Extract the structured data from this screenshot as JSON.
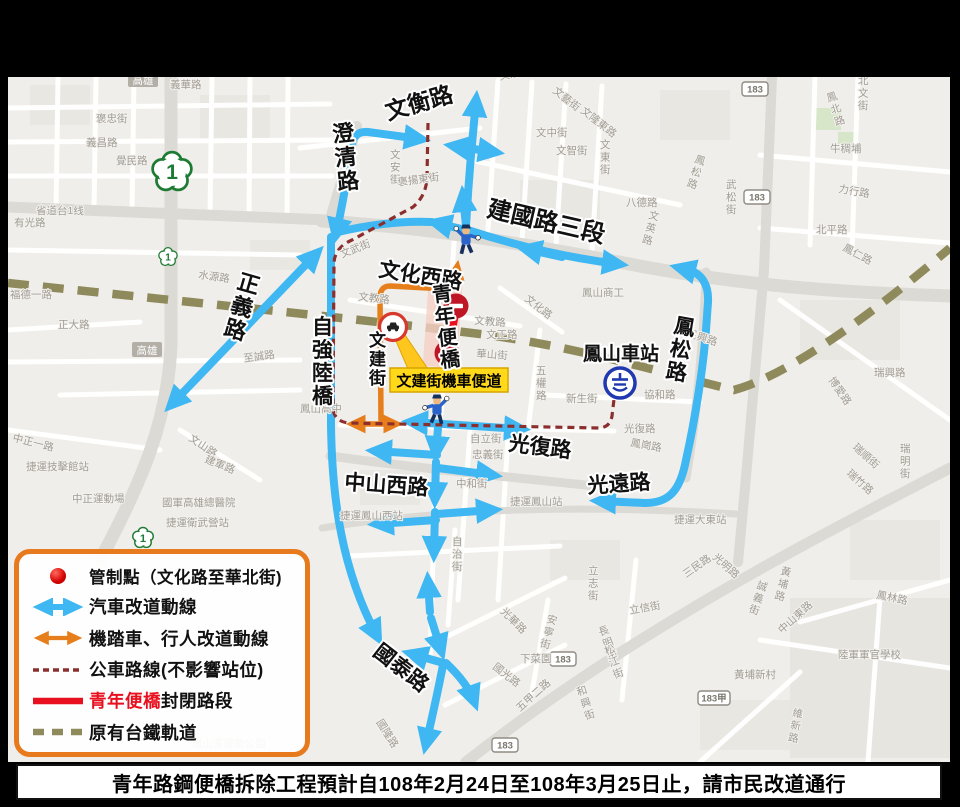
{
  "colors": {
    "car_route": "#3EB7F2",
    "moto_route": "#E67E1B",
    "bus_route": "#8B2E2E",
    "closure_red": "#E8101E",
    "no_entry_sign": "#BF1625",
    "railway_olive": "#8F8A5B",
    "legend_border": "#E87A1E",
    "tag_yellow": "#FFD91A",
    "station_blue": "#1721C8",
    "map_bg": "#F0EEEA",
    "shield_green": "#1E7B34"
  },
  "legend": {
    "items": [
      {
        "label": "管制點（文化路至華北街)",
        "swatch": "control-point-dot"
      },
      {
        "label": "汽車改道動線",
        "swatch": "blue-double-arrow"
      },
      {
        "label": "機踏車、行人改道動線",
        "swatch": "orange-double-arrow"
      },
      {
        "label": "公車路線(不影響站位)",
        "swatch": "dark-red-dashed"
      },
      {
        "label_red": "青年便橋",
        "label_black": "封閉路段",
        "swatch": "red-solid"
      },
      {
        "label": "原有台鐵軌道",
        "swatch": "olive-dashed"
      }
    ]
  },
  "caption": {
    "text": "青年路鋼便橋拆除工程預計自108年2月24日至108年3月25日止，請市民改道通行"
  },
  "annotations": {
    "bike_lane_label": "文建街機車便道"
  },
  "shields": {
    "provincial": "1",
    "route_183": [
      {
        "t": "183",
        "x": 755,
        "y": 89
      },
      {
        "t": "183",
        "x": 757,
        "y": 197
      },
      {
        "t": "183",
        "x": 563,
        "y": 659
      },
      {
        "t": "183",
        "x": 505,
        "y": 745
      },
      {
        "t": "183甲",
        "x": 714,
        "y": 698
      }
    ],
    "city_badges": [
      {
        "t": "高雄",
        "x": 143,
        "y": 80
      },
      {
        "t": "高雄",
        "x": 147,
        "y": 350
      }
    ]
  },
  "labels": {
    "major": [
      {
        "t": "文衡路",
        "x": 388,
        "y": 120,
        "r": -16,
        "s": 23
      },
      {
        "t": "澄清路",
        "x": 333,
        "y": 142,
        "s": 22,
        "v": true,
        "r": -6
      },
      {
        "t": "建國路三段",
        "x": 486,
        "y": 216,
        "r": 13,
        "s": 24
      },
      {
        "t": "文化西路",
        "x": 378,
        "y": 276,
        "r": 9,
        "s": 21
      },
      {
        "t": "正義路",
        "x": 236,
        "y": 288,
        "s": 22,
        "v": true,
        "r": 16
      },
      {
        "t": "自強陸橋",
        "x": 312,
        "y": 334,
        "s": 21,
        "v": true
      },
      {
        "t": "文建街",
        "x": 369,
        "y": 346,
        "s": 17,
        "v": true
      },
      {
        "t": "青年便橋",
        "x": 433,
        "y": 302,
        "s": 20,
        "v": true,
        "r": -7,
        "c": "#E8101E"
      },
      {
        "t": "鳳山車站",
        "x": 583,
        "y": 360,
        "s": 19,
        "c": "#1721C8"
      },
      {
        "t": "鳳松路",
        "x": 673,
        "y": 332,
        "s": 21,
        "v": true,
        "r": 10
      },
      {
        "t": "光復路",
        "x": 508,
        "y": 450,
        "r": 7,
        "s": 21
      },
      {
        "t": "中山西路",
        "x": 344,
        "y": 489,
        "r": 4,
        "s": 21
      },
      {
        "t": "光遠路",
        "x": 588,
        "y": 493,
        "r": -4,
        "s": 21
      },
      {
        "t": "國泰路",
        "x": 372,
        "y": 654,
        "r": 38,
        "s": 21
      }
    ],
    "minor": [
      {
        "t": "義華路",
        "x": 170,
        "y": 88
      },
      {
        "t": "褒忠街",
        "x": 96,
        "y": 122
      },
      {
        "t": "義昌路",
        "x": 86,
        "y": 146
      },
      {
        "t": "覺民路",
        "x": 116,
        "y": 164
      },
      {
        "t": "省道台1线",
        "x": 36,
        "y": 214
      },
      {
        "t": "有光路",
        "x": 14,
        "y": 226
      },
      {
        "t": "水源路",
        "x": 198,
        "y": 278,
        "r": 8
      },
      {
        "t": "福德一路",
        "x": 10,
        "y": 298
      },
      {
        "t": "正大路",
        "x": 58,
        "y": 328
      },
      {
        "t": "至誠路",
        "x": 244,
        "y": 362,
        "r": -8
      },
      {
        "t": "中正一路",
        "x": 12,
        "y": 441,
        "r": 14
      },
      {
        "t": "文山路",
        "x": 188,
        "y": 440,
        "r": 34
      },
      {
        "t": "建軍路",
        "x": 204,
        "y": 462,
        "r": 22
      },
      {
        "t": "捷運技擊館站",
        "x": 26,
        "y": 470
      },
      {
        "t": "中正運動場",
        "x": 72,
        "y": 502
      },
      {
        "t": "國軍高雄總醫院",
        "x": 162,
        "y": 506
      },
      {
        "t": "捷運衛武營站",
        "x": 166,
        "y": 526
      },
      {
        "t": "鳳山區運動公園",
        "x": 192,
        "y": 747
      },
      {
        "t": "文濱街",
        "x": 500,
        "y": 80,
        "r": -12
      },
      {
        "t": "文藝街",
        "x": 552,
        "y": 92,
        "r": 38
      },
      {
        "t": "文隆東路",
        "x": 580,
        "y": 112,
        "r": 38
      },
      {
        "t": "文中街",
        "x": 536,
        "y": 136
      },
      {
        "t": "文智街",
        "x": 556,
        "y": 154
      },
      {
        "t": "文東街",
        "x": 600,
        "y": 148,
        "v": true
      },
      {
        "t": "八德路",
        "x": 626,
        "y": 206
      },
      {
        "t": "文英路",
        "x": 648,
        "y": 218,
        "v": true,
        "r": 15
      },
      {
        "t": "武松街",
        "x": 726,
        "y": 188,
        "v": true
      },
      {
        "t": "鳳松路",
        "x": 694,
        "y": 162,
        "v": true,
        "r": 18
      },
      {
        "t": "北文街",
        "x": 858,
        "y": 84,
        "v": true
      },
      {
        "t": "鳳北路",
        "x": 828,
        "y": 102,
        "v": true,
        "r": -18
      },
      {
        "t": "牛稠埔",
        "x": 830,
        "y": 152
      },
      {
        "t": "力行路",
        "x": 838,
        "y": 192,
        "r": 10
      },
      {
        "t": "北平路",
        "x": 816,
        "y": 233
      },
      {
        "t": "鳳仁路",
        "x": 842,
        "y": 250,
        "r": 28
      },
      {
        "t": "文安街",
        "x": 390,
        "y": 158,
        "v": true
      },
      {
        "t": "褒揚東街",
        "x": 398,
        "y": 186,
        "r": -8
      },
      {
        "t": "文武街",
        "x": 342,
        "y": 258,
        "r": -22
      },
      {
        "t": "文教路",
        "x": 358,
        "y": 300,
        "r": 6
      },
      {
        "t": "文教路",
        "x": 474,
        "y": 324,
        "r": 4
      },
      {
        "t": "文化路",
        "x": 524,
        "y": 300,
        "r": 38
      },
      {
        "t": "文正路",
        "x": 486,
        "y": 338
      },
      {
        "t": "華山街",
        "x": 476,
        "y": 357,
        "r": 4
      },
      {
        "t": "鳳山商工",
        "x": 582,
        "y": 296
      },
      {
        "t": "鳳山高中",
        "x": 300,
        "y": 412
      },
      {
        "t": "五權路",
        "x": 536,
        "y": 374,
        "v": true
      },
      {
        "t": "新生街",
        "x": 566,
        "y": 402
      },
      {
        "t": "協和路",
        "x": 644,
        "y": 398
      },
      {
        "t": "民興路",
        "x": 686,
        "y": 336,
        "r": 18
      },
      {
        "t": "瑞興路",
        "x": 874,
        "y": 376
      },
      {
        "t": "博愛路",
        "x": 828,
        "y": 380,
        "r": 55
      },
      {
        "t": "瑞順街",
        "x": 852,
        "y": 448,
        "r": 42
      },
      {
        "t": "瑞明街",
        "x": 900,
        "y": 452,
        "v": true
      },
      {
        "t": "瑞竹路",
        "x": 846,
        "y": 474,
        "r": 42
      },
      {
        "t": "光復路",
        "x": 624,
        "y": 432
      },
      {
        "t": "鳳崗路",
        "x": 630,
        "y": 446,
        "r": 10
      },
      {
        "t": "自立街",
        "x": 470,
        "y": 442
      },
      {
        "t": "忠義街",
        "x": 472,
        "y": 458
      },
      {
        "t": "中和街",
        "x": 456,
        "y": 487
      },
      {
        "t": "自治街",
        "x": 452,
        "y": 545,
        "v": true
      },
      {
        "t": "捷運鳳山西站",
        "x": 340,
        "y": 519
      },
      {
        "t": "捷運鳳山站",
        "x": 510,
        "y": 505
      },
      {
        "t": "捷運大東站",
        "x": 674,
        "y": 523
      },
      {
        "t": "光明路",
        "x": 712,
        "y": 558,
        "r": 42
      },
      {
        "t": "三民路",
        "x": 686,
        "y": 578,
        "r": -35
      },
      {
        "t": "立志街",
        "x": 588,
        "y": 574,
        "v": true
      },
      {
        "t": "安寧街",
        "x": 546,
        "y": 622,
        "v": true,
        "r": 15
      },
      {
        "t": "光華路",
        "x": 500,
        "y": 612,
        "r": 45
      },
      {
        "t": "國光路",
        "x": 492,
        "y": 668,
        "r": 38
      },
      {
        "t": "下菜園",
        "x": 520,
        "y": 662
      },
      {
        "t": "立信街",
        "x": 630,
        "y": 614,
        "r": -10
      },
      {
        "t": "長明街",
        "x": 600,
        "y": 636,
        "v": true,
        "r": -20
      },
      {
        "t": "松江街",
        "x": 606,
        "y": 655,
        "v": true,
        "r": -20
      },
      {
        "t": "和興街",
        "x": 578,
        "y": 696,
        "v": true,
        "r": -18
      },
      {
        "t": "五甲二路",
        "x": 520,
        "y": 712,
        "r": -42
      },
      {
        "t": "國隆路",
        "x": 376,
        "y": 722,
        "r": 58
      },
      {
        "t": "鳳林路",
        "x": 876,
        "y": 598,
        "r": 12
      },
      {
        "t": "誠義街",
        "x": 756,
        "y": 588,
        "v": true,
        "r": 18
      },
      {
        "t": "黃埔路",
        "x": 780,
        "y": 574,
        "v": true,
        "r": 14
      },
      {
        "t": "中山東路",
        "x": 782,
        "y": 634,
        "r": -42
      },
      {
        "t": "陸軍軍官學校",
        "x": 838,
        "y": 658
      },
      {
        "t": "黃埔新村",
        "x": 734,
        "y": 678
      },
      {
        "t": "維新路",
        "x": 792,
        "y": 716,
        "v": true,
        "r": 10
      }
    ]
  }
}
